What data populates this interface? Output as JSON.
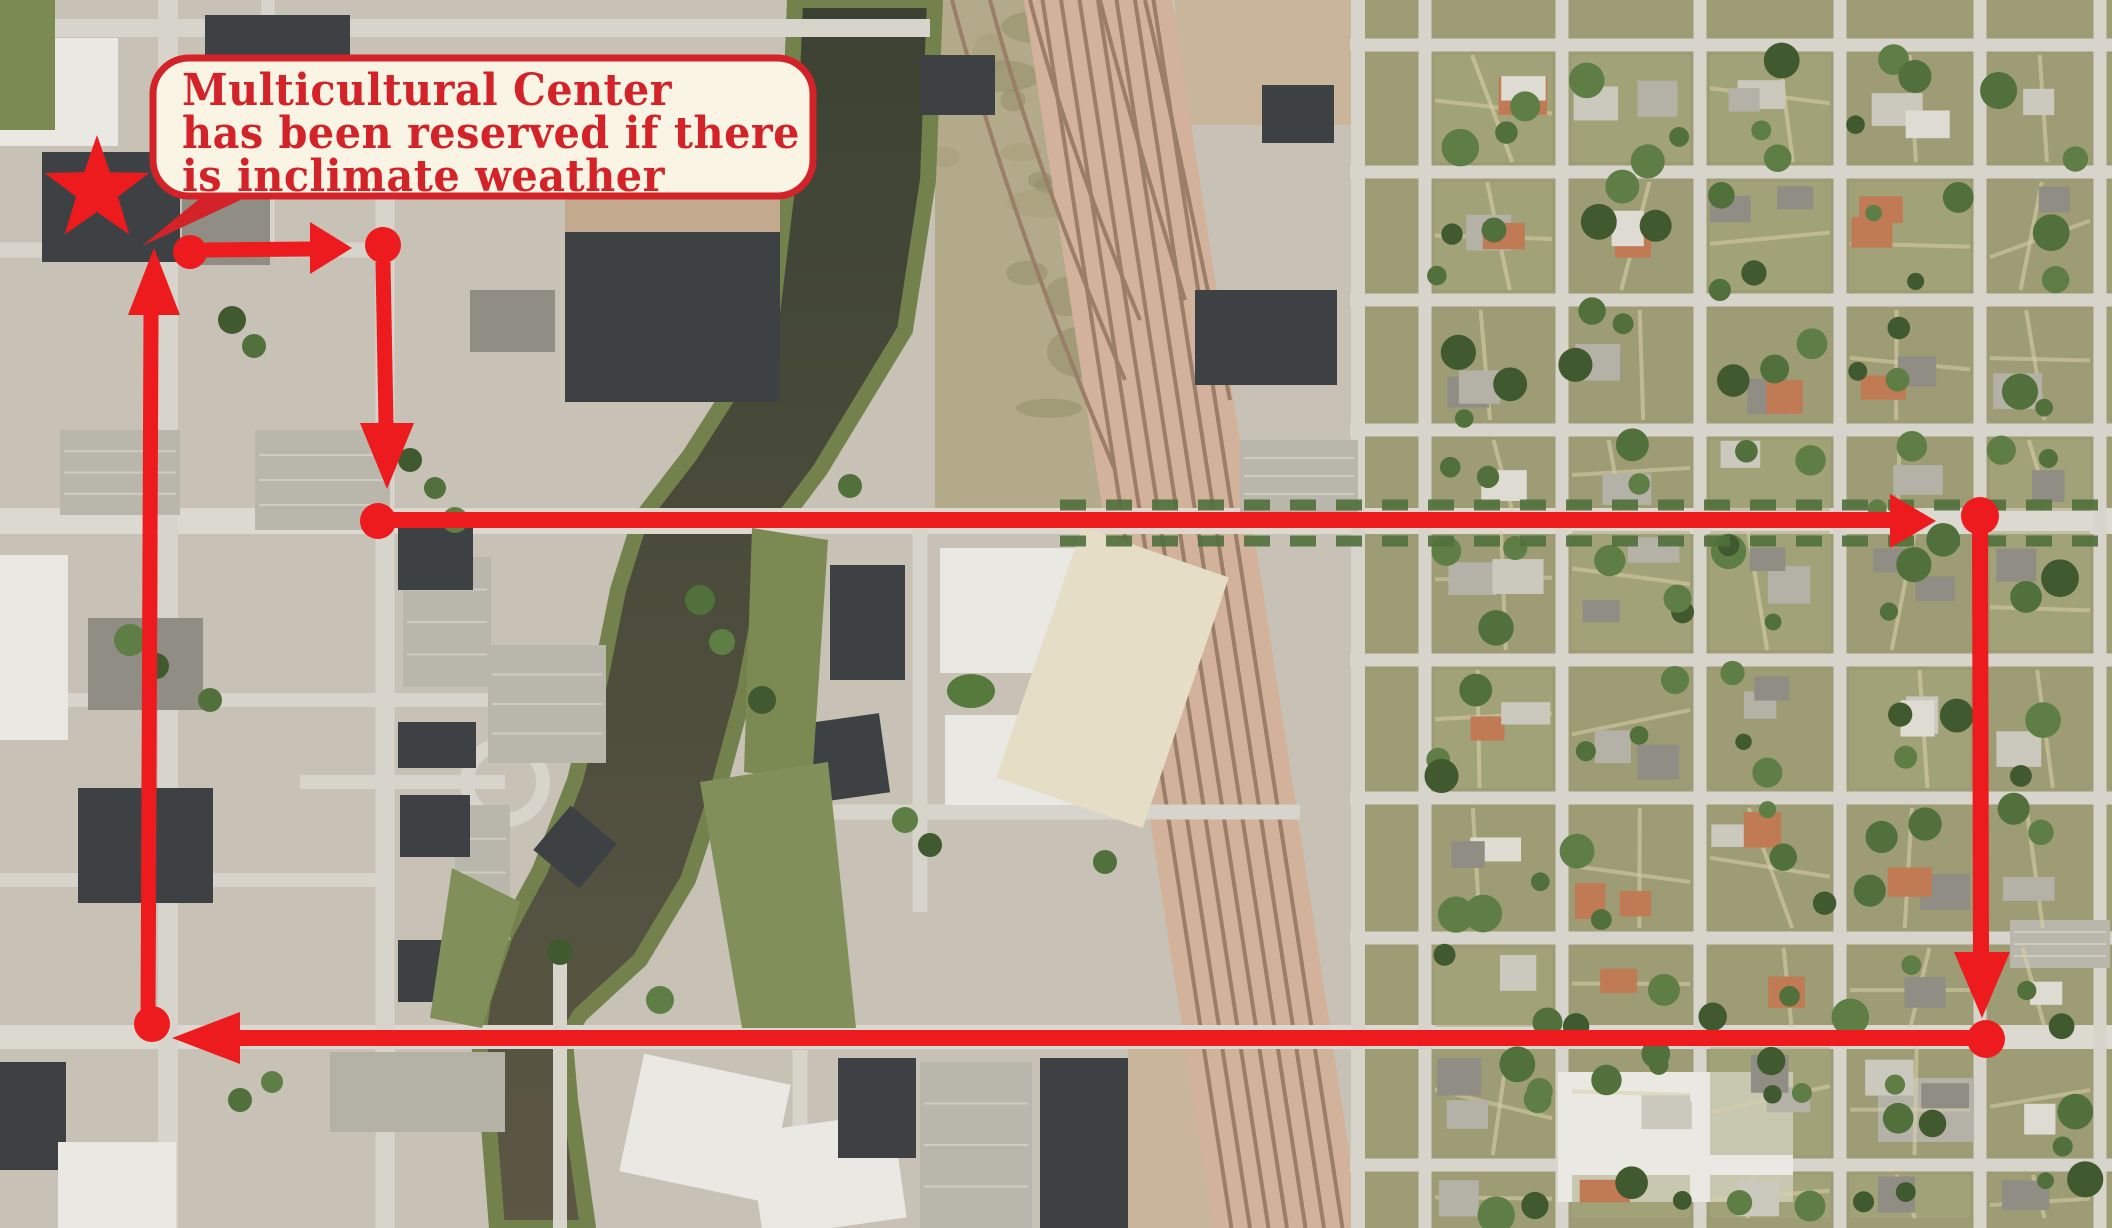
{
  "callout": {
    "lines": [
      "Multicultural Center",
      "has been reserved if there",
      "is inclimate weather"
    ],
    "fill": "#f9f4e3",
    "border_color": "#d32329",
    "text_color": "#d32329"
  },
  "route": {
    "color": "#ee1b1e",
    "star": {
      "x": 97,
      "y": 190,
      "outer_r": 55,
      "inner_r": 22
    },
    "tail": [
      [
        210,
        190
      ],
      [
        142,
        246
      ],
      [
        262,
        190
      ]
    ],
    "dots": [
      [
        190,
        252,
        17
      ],
      [
        383,
        245,
        18
      ],
      [
        378,
        521,
        18
      ],
      [
        1980,
        516,
        19
      ],
      [
        1986,
        1039,
        19
      ],
      [
        152,
        1024,
        18
      ]
    ],
    "segments": [
      [
        205,
        250,
        314,
        249,
        15
      ],
      [
        383,
        262,
        386,
        424,
        15
      ],
      [
        393,
        520,
        1892,
        520,
        16
      ],
      [
        1980,
        530,
        1981,
        954,
        16
      ],
      [
        1970,
        1038,
        238,
        1038,
        16
      ],
      [
        148,
        1022,
        151,
        313,
        15
      ]
    ],
    "arrowheads": [
      [
        352,
        248,
        310,
        222,
        310,
        274
      ],
      [
        387,
        489,
        360,
        423,
        414,
        423
      ],
      [
        1936,
        521,
        1890,
        494,
        1890,
        548
      ],
      [
        1982,
        1018,
        1954,
        952,
        2010,
        952
      ],
      [
        172,
        1038,
        240,
        1012,
        240,
        1064
      ],
      [
        154,
        248,
        128,
        315,
        180,
        315
      ]
    ]
  },
  "map": {
    "palette": {
      "base": "#c7c2b5",
      "road": "#d7d4cb",
      "road_major": "#dcd9d1",
      "water_top": "#3c4233",
      "water_bottom": "#5c5744",
      "bank_green": "#73824d",
      "rail_bed": "#d3b29b",
      "rail_track": "#9b7e68",
      "scrub": "#b2aa88",
      "dirt": "#c9b69a",
      "lawn": "#9d9c74",
      "parking": "#b9b6ac",
      "park_green": "#7b8a53",
      "park_green2": "#81905a",
      "oval_green": "#567a3b",
      "tree_dark": "#41592f",
      "tree_mid": "#51703c",
      "tree_light": "#5f7e46",
      "house_gray": "#b4b1a7",
      "house_dark": "#8f8d84",
      "house_tan": "#cbc8be",
      "house_orange": "#c07b55",
      "building_dark": "#3d4144",
      "white_bldg": "#e9e8e2",
      "cream_bldg": "#e6ddc6",
      "sidewalk": "#d8cfa8"
    },
    "zones": [
      {
        "type": "rect",
        "x": 1352,
        "y": 0,
        "w": 760,
        "h": 1228,
        "fill": "lawn"
      },
      {
        "type": "poly",
        "pts": [
          [
            935,
            0
          ],
          [
            1026,
            0
          ],
          [
            1105,
            520
          ],
          [
            935,
            520
          ]
        ],
        "fill": "scrub"
      },
      {
        "type": "rect",
        "x": 1175,
        "y": 0,
        "w": 180,
        "h": 125,
        "fill": "dirt"
      },
      {
        "type": "rect",
        "x": 1128,
        "y": 1048,
        "w": 112,
        "h": 180,
        "fill": "dirt"
      }
    ],
    "river": {
      "left": [
        [
          795,
          0
        ],
        [
          788,
          180
        ],
        [
          770,
          330
        ],
        [
          690,
          455
        ],
        [
          640,
          520
        ],
        [
          618,
          590
        ],
        [
          600,
          680
        ],
        [
          575,
          780
        ],
        [
          540,
          870
        ],
        [
          505,
          935
        ],
        [
          483,
          1000
        ],
        [
          478,
          1037
        ],
        [
          487,
          1100
        ],
        [
          497,
          1228
        ]
      ],
      "right": [
        [
          935,
          0
        ],
        [
          928,
          180
        ],
        [
          905,
          330
        ],
        [
          820,
          470
        ],
        [
          775,
          530
        ],
        [
          762,
          600
        ],
        [
          745,
          690
        ],
        [
          718,
          790
        ],
        [
          688,
          880
        ],
        [
          640,
          960
        ],
        [
          580,
          1015
        ],
        [
          565,
          1040
        ],
        [
          570,
          1100
        ],
        [
          588,
          1228
        ]
      ]
    },
    "railroad": {
      "poly": [
        [
          1024,
          0
        ],
        [
          1172,
          0
        ],
        [
          1361,
          1228
        ],
        [
          1213,
          1228
        ]
      ],
      "tracks": 7,
      "spurs": [
        "M 952 0 Q 1010 220 1115 470",
        "M 990 0 Q 1035 170 1125 380",
        "M 1030 0 Q 1065 140 1140 320",
        "M 1100 0 Q 1130 120 1185 300",
        "M 1145 0 Q 1180 150 1230 400"
      ]
    },
    "roads": {
      "h": [
        [
          28,
          0,
          930,
          18,
          0
        ],
        [
          250,
          0,
          388,
          15,
          0
        ],
        [
          521,
          0,
          2112,
          26,
          1
        ],
        [
          1037,
          0,
          2112,
          24,
          1
        ],
        [
          700,
          0,
          560,
          14,
          0
        ],
        [
          880,
          0,
          390,
          14,
          0
        ],
        [
          812,
          750,
          1300,
          15,
          0
        ],
        [
          782,
          300,
          505,
          14,
          0
        ],
        [
          45,
          1350,
          2112,
          13,
          0
        ],
        [
          172,
          1350,
          2112,
          13,
          0
        ],
        [
          300,
          1350,
          2112,
          13,
          0
        ],
        [
          430,
          1350,
          2112,
          13,
          0
        ],
        [
          660,
          1350,
          2112,
          13,
          0
        ],
        [
          798,
          1350,
          2112,
          13,
          0
        ],
        [
          938,
          1350,
          2112,
          13,
          0
        ],
        [
          1165,
          1350,
          2112,
          13,
          0
        ]
      ],
      "v": [
        [
          168,
          0,
          1228,
          20
        ],
        [
          268,
          0,
          250,
          13
        ],
        [
          385,
          180,
          1228,
          19
        ],
        [
          560,
          950,
          1228,
          14
        ],
        [
          800,
          1050,
          1228,
          15
        ],
        [
          920,
          520,
          912,
          15
        ],
        [
          1358,
          0,
          1228,
          14
        ],
        [
          1425,
          0,
          1228,
          13
        ],
        [
          1562,
          0,
          1228,
          13
        ],
        [
          1700,
          0,
          1228,
          13
        ],
        [
          1840,
          0,
          1228,
          13
        ],
        [
          1980,
          0,
          1228,
          13
        ],
        [
          2100,
          0,
          1228,
          13
        ]
      ]
    },
    "parking_lots": [
      [
        60,
        430,
        120,
        85
      ],
      [
        255,
        430,
        135,
        100
      ],
      [
        403,
        557,
        88,
        130
      ],
      [
        488,
        645,
        118,
        118
      ],
      [
        300,
        55,
        95,
        60
      ],
      [
        920,
        1062,
        112,
        166
      ],
      [
        455,
        805,
        55,
        135
      ],
      [
        1240,
        440,
        118,
        72
      ],
      [
        2010,
        920,
        100,
        48
      ]
    ],
    "buildings": [
      [
        0,
        38,
        118,
        108,
        "white_bldg",
        0
      ],
      [
        42,
        152,
        138,
        110,
        "building_dark",
        0
      ],
      [
        205,
        15,
        145,
        78,
        "building_dark",
        0
      ],
      [
        182,
        150,
        88,
        115,
        "house_dark",
        0
      ],
      [
        580,
        95,
        225,
        85,
        "white_bldg",
        0
      ],
      [
        565,
        180,
        215,
        222,
        "building_dark",
        0
      ],
      [
        420,
        100,
        95,
        72,
        "building_dark",
        0
      ],
      [
        398,
        528,
        75,
        62,
        "building_dark",
        0
      ],
      [
        398,
        722,
        78,
        46,
        "building_dark",
        0
      ],
      [
        400,
        795,
        70,
        62,
        "building_dark",
        0
      ],
      [
        398,
        940,
        74,
        62,
        "building_dark",
        0
      ],
      [
        545,
        818,
        60,
        58,
        "building_dark",
        40
      ],
      [
        88,
        618,
        115,
        92,
        "house_dark",
        0
      ],
      [
        78,
        788,
        135,
        115,
        "building_dark",
        0
      ],
      [
        0,
        555,
        68,
        185,
        "white_bldg",
        0
      ],
      [
        940,
        548,
        155,
        125,
        "white_bldg",
        0
      ],
      [
        945,
        715,
        150,
        90,
        "white_bldg",
        0
      ],
      [
        830,
        565,
        75,
        115,
        "building_dark",
        0
      ],
      [
        780,
        720,
        105,
        80,
        "building_dark",
        -8
      ],
      [
        1035,
        545,
        155,
        265,
        "cream_bldg",
        19
      ],
      [
        1195,
        290,
        142,
        95,
        "building_dark",
        0
      ],
      [
        1262,
        85,
        72,
        58,
        "building_dark",
        0
      ],
      [
        920,
        55,
        75,
        60,
        "building_dark",
        0
      ],
      [
        630,
        1068,
        150,
        120,
        "white_bldg",
        12
      ],
      [
        755,
        1122,
        145,
        106,
        "white_bldg",
        -8
      ],
      [
        838,
        1058,
        78,
        100,
        "building_dark",
        0
      ],
      [
        1040,
        1058,
        88,
        170,
        "building_dark",
        0
      ],
      [
        1558,
        1072,
        235,
        130,
        "white_bldg",
        0
      ],
      [
        0,
        1062,
        66,
        108,
        "building_dark",
        0
      ],
      [
        58,
        1142,
        118,
        86,
        "white_bldg",
        0
      ],
      [
        330,
        1052,
        175,
        80,
        "house_gray",
        0
      ],
      [
        470,
        290,
        85,
        62,
        "house_dark",
        0
      ],
      [
        1878,
        1078,
        96,
        64,
        "house_gray",
        0
      ]
    ],
    "greens": [
      {
        "type": "rect",
        "x": 0,
        "y": 0,
        "w": 55,
        "h": 130,
        "fill": "park_green"
      },
      {
        "type": "poly",
        "pts": [
          [
            752,
            528
          ],
          [
            828,
            540
          ],
          [
            812,
            782
          ],
          [
            744,
            772
          ]
        ],
        "fill": "park_green"
      },
      {
        "type": "poly",
        "pts": [
          [
            700,
            782
          ],
          [
            828,
            762
          ],
          [
            856,
            1028
          ],
          [
            742,
            1028
          ]
        ],
        "fill": "park_green2"
      },
      {
        "type": "poly",
        "pts": [
          [
            452,
            868
          ],
          [
            520,
            902
          ],
          [
            482,
            1028
          ],
          [
            430,
            1018
          ]
        ],
        "fill": "park_green2"
      },
      {
        "type": "ellipse",
        "cx": 971,
        "cy": 691,
        "rx": 24,
        "ry": 17,
        "fill": "oval_green"
      },
      {
        "type": "rect",
        "x": 688,
        "y": 58,
        "w": 72,
        "h": 52,
        "fill": "park_green2"
      },
      {
        "type": "rect",
        "x": 745,
        "y": 95,
        "w": 60,
        "h": 42,
        "fill": "park_green"
      }
    ],
    "trees_downtown": [
      [
        232,
        320,
        14
      ],
      [
        254,
        346,
        12
      ],
      [
        130,
        640,
        16
      ],
      [
        156,
        666,
        13
      ],
      [
        210,
        700,
        12
      ],
      [
        455,
        520,
        13
      ],
      [
        340,
        182,
        12
      ],
      [
        700,
        600,
        15
      ],
      [
        722,
        642,
        13
      ],
      [
        762,
        700,
        14
      ],
      [
        850,
        486,
        12
      ],
      [
        660,
        1000,
        14
      ],
      [
        560,
        952,
        13
      ],
      [
        240,
        1100,
        12
      ],
      [
        272,
        1082,
        11
      ],
      [
        410,
        460,
        12
      ],
      [
        435,
        488,
        11
      ],
      [
        905,
        820,
        13
      ],
      [
        930,
        845,
        12
      ],
      [
        1105,
        862,
        12
      ],
      [
        520,
        120,
        13
      ],
      [
        545,
        95,
        12
      ]
    ],
    "street_trees": {
      "y1": 505,
      "y2": 541,
      "x1": 1060,
      "x2": 2112
    },
    "residential": {
      "vs": [
        1368,
        1425,
        1562,
        1700,
        1840,
        1980,
        2100
      ],
      "hs": [
        0,
        45,
        172,
        300,
        430,
        521,
        660,
        798,
        938,
        1037,
        1165,
        1228
      ],
      "seed": 11
    }
  }
}
